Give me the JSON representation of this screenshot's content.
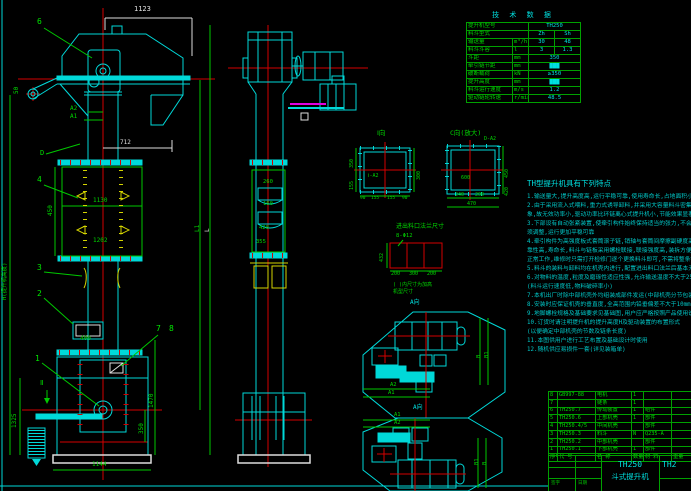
{
  "front": {
    "dim_1123": "1123",
    "dim_a2": "A2",
    "dim_a1": "A1",
    "dim_712": "712",
    "dim_50": "50",
    "dim_450": "450",
    "dim_1130": "1130",
    "dim_1202": "1202",
    "dim_400": "400",
    "dim_1325": "1325",
    "dim_1470": "1470",
    "dim_350": "350",
    "dim_1144": "1144",
    "dim_h": "H(提升机高度)",
    "dim_l1": "L1",
    "dim_l": "L",
    "label_d": "D",
    "label_sec2": "Ⅱ",
    "balloon_6": "6",
    "balloon_4": "4",
    "balloon_3": "3",
    "balloon_2": "2",
    "balloon_1": "1",
    "balloon_7": "7",
    "balloon_8": "8"
  },
  "side": {
    "dim_260": "260",
    "dim_160": "160",
    "dim_420": "420",
    "dim_355": "355"
  },
  "details": {
    "flange_i": {
      "label": "Ⅰ向",
      "note": "Ⅰ-A2",
      "d90a": "90",
      "d155a": "155",
      "d155b": "155",
      "d90b": "90",
      "d300": "300",
      "d350": "350",
      "d155l": "155"
    },
    "flange_c": {
      "label": "C向(放大)",
      "note": "D-A2",
      "d240": "240",
      "d200": "200",
      "d470": "470",
      "d450": "450",
      "d420": "420",
      "d600": "600"
    },
    "caption": "进出料口法兰尺寸",
    "outlet": {
      "holes": "8-Φ12",
      "d432": "432",
      "b1": "200",
      "b2": "300",
      "b3": "200",
      "note1": "( )内尺寸为加高",
      "note2": "机型尺寸"
    },
    "plan1": {
      "label": "A向",
      "a2": "A2",
      "a1": "A1",
      "b": "B",
      "b1": "B1"
    },
    "plan2": {
      "label": "A向",
      "a1": "A1",
      "a2": "A2",
      "b1": "B1",
      "b": "B"
    }
  },
  "spec": {
    "title": "技 术 数 据",
    "rows": [
      {
        "label": "提升机型号",
        "unit": "",
        "v1": "TH250",
        "v2": ""
      },
      {
        "label": "料斗型式",
        "unit": "",
        "v1": "Zh",
        "v2": "Sh"
      },
      {
        "label": "输送量",
        "unit": "m³/h",
        "v1": "30",
        "v2": "48"
      },
      {
        "label": "料斗斗容",
        "unit": "l",
        "v1": "3",
        "v2": "1.3"
      },
      {
        "label": "斗距",
        "unit": "mm",
        "v1": "350",
        "v2": ""
      },
      {
        "label": "牵引链节距",
        "unit": "mm",
        "v1": "███",
        "v2": ""
      },
      {
        "label": "破断载荷",
        "unit": "kN",
        "v1": "≥350",
        "v2": ""
      },
      {
        "label": "提升高度",
        "unit": "mm",
        "v1": "███",
        "v2": ""
      },
      {
        "label": "料斗运行速度",
        "unit": "m/s",
        "v1": "1.2",
        "v2": ""
      },
      {
        "label": "驱动链轮转速",
        "unit": "r/min",
        "v1": "48.5",
        "v2": ""
      }
    ]
  },
  "features": {
    "title": "TH型提升机具有下列特点",
    "lines": [
      "1.输送量大,提升高度高,运行平稳可靠,使用寿命长,占地面积小是其一大特点",
      "2.由于采用流入式喂料,重力式诱导卸料,并采用大容量料斗密集布置,物料提升时几乎无回料和挖料现",
      "  象,故无效功率小,驱动功率比环链离心式提升机小,节能效果显著",
      "3.下部设有自动张紧装置,使牵引构件始终保持适当的张力,不会因链条磨损伸长而松弛,一定范围内无",
      "  须调整,运行更加平稳可靠",
      "4.牵引构件为高强度板式套筒滚子链,销轴与套筒间摩擦副硬度高且接触良好,耐磨损性能突出,工作的可",
      "  靠性高,寿命长,料斗与链板采用螺栓联接,联接强度高,装拆方便,即使个别料斗损坏也不影响整机",
      "  正常工作,维修时只需打开检修门逐个更换料斗即可,不需将整条链取出",
      "5.料斗的装料与卸料均在机壳内进行,配置进出料口法兰后基本无粉尘外溢,对环境污染小,密封性能好",
      "6.对物料的温度,粒度及磨琢性适应性强,允许输送温度不大于250℃的物料",
      "  (料斗运行速度低,物料破碎率小)",
      "7.本机出厂时除中部机壳外均组装成部件发运(中部机壳分节包装发运)",
      "8.安装时应保证机壳的垂直度,全高范围内铅垂偏差不大于10mm",
      "9.地脚螺栓规格及基础要求见基础图,用户应严格按照产品使用说明书中的规定进行安装,使用与维护",
      "10.订货时请注明提升机的提升高度H及驱动装置的布置形式",
      "  (以便确定中部机壳的节数及链条长度)",
      "11.本图供用户进行工艺布置及基础设计时使用",
      "12.随机供应易损件一套(详见装箱单)"
    ]
  },
  "bom": {
    "header": {
      "no": "序号",
      "code": "代 号",
      "name": "名 称",
      "qty": "数量",
      "mat": "材 料",
      "wt": "重量"
    },
    "rows": [
      {
        "no": "8",
        "code": "GB997-88",
        "name": "电机",
        "qty": "1",
        "mat": "",
        "wt": ""
      },
      {
        "no": "7",
        "code": "",
        "name": "链条",
        "qty": "1",
        "mat": "",
        "wt": ""
      },
      {
        "no": "6",
        "code": "TH250.7",
        "name": "传动装置",
        "qty": "1",
        "mat": "组件",
        "wt": ""
      },
      {
        "no": "5",
        "code": "TH250.6",
        "name": "上部机壳",
        "qty": "1",
        "mat": "部件",
        "wt": ""
      },
      {
        "no": "4",
        "code": "TH250.4/5",
        "name": "中间机壳",
        "qty": "",
        "mat": "部件",
        "wt": ""
      },
      {
        "no": "3",
        "code": "TH250.3",
        "name": "料斗",
        "qty": "N",
        "mat": "Q235-A",
        "wt": ""
      },
      {
        "no": "2",
        "code": "TH250.2",
        "name": "中部机壳",
        "qty": "",
        "mat": "部件",
        "wt": ""
      },
      {
        "no": "1",
        "code": "TH250.1",
        "name": "下部机壳",
        "qty": "1",
        "mat": "部件",
        "wt": ""
      }
    ]
  },
  "titleblock": {
    "model": "TH250",
    "name": "斗式提升机",
    "model_right": "TH2",
    "sig1": "签字",
    "sig2": "日期"
  }
}
